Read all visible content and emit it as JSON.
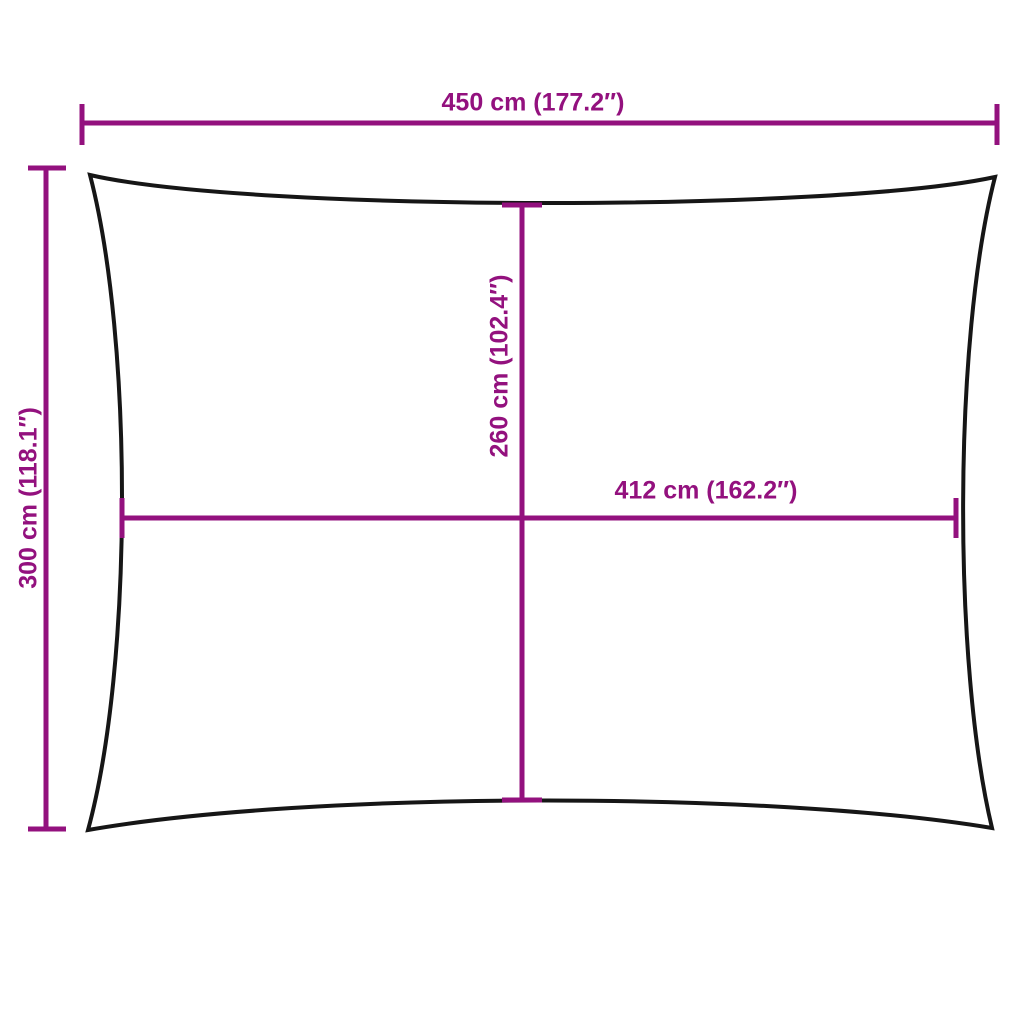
{
  "diagram": {
    "colors": {
      "dimension_lines": "#93117E",
      "label_text": "#93117E",
      "sail_outline": "#161616",
      "background": "#ffffff"
    },
    "dimensions": {
      "width": {
        "label": "450 cm (177.2″)",
        "cm": 450,
        "inches": 177.2
      },
      "height": {
        "label": "300 cm (118.1″)",
        "cm": 300,
        "inches": 118.1
      },
      "inner_width": {
        "label": "412 cm (162.2″)",
        "cm": 412,
        "inches": 162.2
      },
      "inner_height": {
        "label": "260 cm (102.4″)",
        "cm": 260,
        "inches": 102.4
      }
    }
  }
}
